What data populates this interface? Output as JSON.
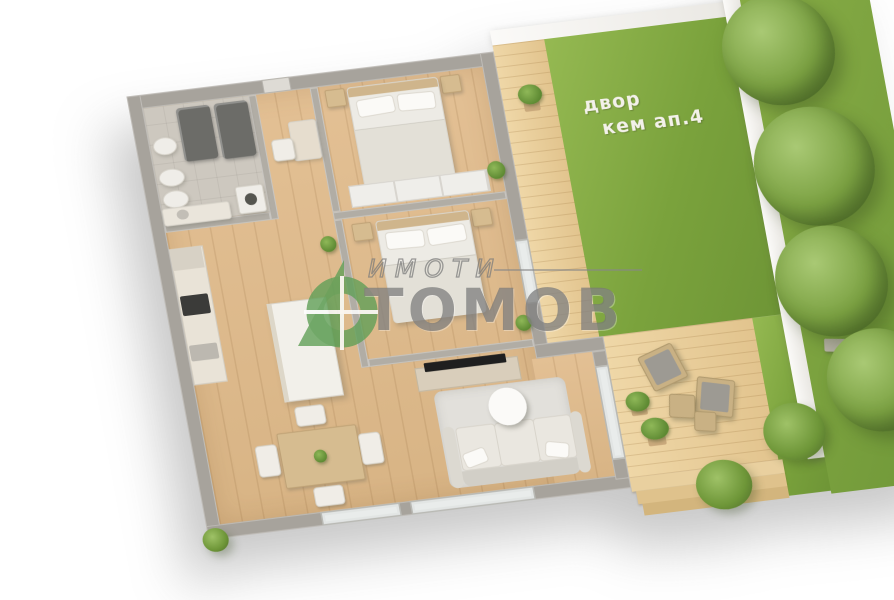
{
  "scene": {
    "background": "#ffffff",
    "lawn_label": {
      "line1": "двор",
      "line2": "кем ап.4",
      "color": "#f3f1ea"
    }
  },
  "watermark": {
    "brand_top": "ИМОТИ",
    "brand_main": "ТОМОВ",
    "text_color": "#8a8a8a",
    "logo_color": "#5f9e56",
    "logo_icon": "house-target-icon"
  },
  "palette": {
    "wood_floor": "#ddb98b",
    "deck_wood": "#ead1a0",
    "lawn_green": "#7ea63e",
    "far_lawn_green": "#74993a",
    "wall_gray": "#a7a39c",
    "tile_gray": "#cdc8bf",
    "boundary_wall_white": "#f4f3f0",
    "tv_black": "#1f1f1f"
  }
}
